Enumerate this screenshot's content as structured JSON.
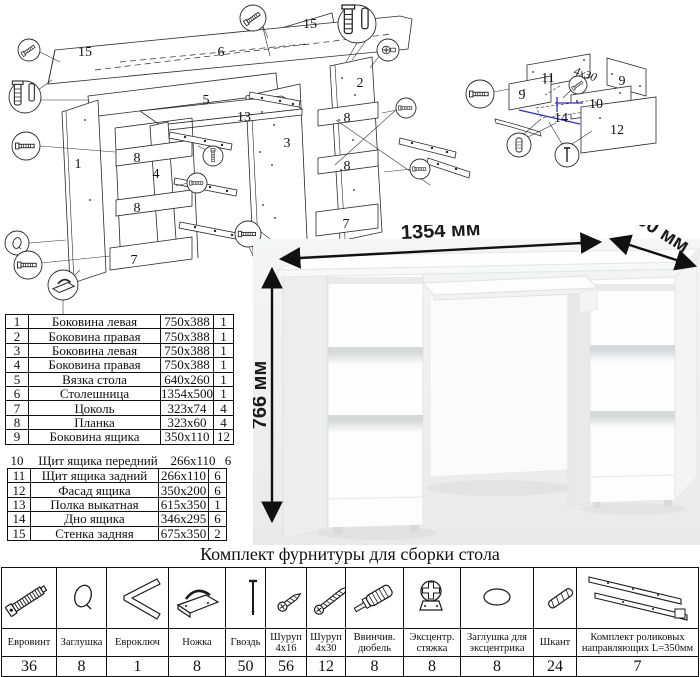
{
  "title": "Комплект фурнитуры для сборки стола",
  "parts_table": {
    "rows": [
      {
        "num": "1",
        "name": "Боковина левая",
        "size": "750x388",
        "qty": "1"
      },
      {
        "num": "2",
        "name": "Боковина правая",
        "size": "750x388",
        "qty": "1"
      },
      {
        "num": "3",
        "name": "Боковина левая",
        "size": "750x388",
        "qty": "1"
      },
      {
        "num": "4",
        "name": "Боковина правая",
        "size": "750x388",
        "qty": "1"
      },
      {
        "num": "5",
        "name": "Вязка стола",
        "size": "640x260",
        "qty": "1"
      },
      {
        "num": "6",
        "name": "Столешница",
        "size": "1354x500",
        "qty": "1"
      },
      {
        "num": "7",
        "name": "Цоколь",
        "size": "323x74",
        "qty": "4"
      },
      {
        "num": "8",
        "name": "Планка",
        "size": "323x60",
        "qty": "4"
      },
      {
        "num": "9",
        "name": "Боковина ящика",
        "size": "350x110",
        "qty": "12"
      },
      {
        "num": "10",
        "name": "Щит ящика передний",
        "size": "266x110",
        "qty": "6"
      },
      {
        "num": "11",
        "name": "Щит ящика задний",
        "size": "266x110",
        "qty": "6"
      },
      {
        "num": "12",
        "name": "Фасад ящика",
        "size": "350x200",
        "qty": "6"
      },
      {
        "num": "13",
        "name": "Полка выкатная",
        "size": "615x350",
        "qty": "1"
      },
      {
        "num": "14",
        "name": "Дно ящика",
        "size": "346x295",
        "qty": "6"
      },
      {
        "num": "15",
        "name": "Стенка задняя",
        "size": "675x350",
        "qty": "2"
      }
    ]
  },
  "dimensions": {
    "width": "1354 мм",
    "depth": "500 мм",
    "height": "766 мм"
  },
  "hardware": {
    "columns": [
      {
        "label": "Евровинт",
        "qty": "36",
        "icon": "euro-screw"
      },
      {
        "label": "Заглушка",
        "qty": "8",
        "icon": "cap"
      },
      {
        "label": "Евроключ",
        "qty": "1",
        "icon": "hex-key"
      },
      {
        "label": "Ножка",
        "qty": "8",
        "icon": "foot"
      },
      {
        "label": "Гвоздь",
        "qty": "50",
        "icon": "nail"
      },
      {
        "label": "Шуруп 4x16",
        "qty": "56",
        "icon": "screw-small"
      },
      {
        "label": "Шуруп 4x30",
        "qty": "12",
        "icon": "screw-long"
      },
      {
        "label": "Ввинчив. дюбель",
        "qty": "8",
        "icon": "dowel-screw"
      },
      {
        "label": "Эксцентр. стяжка",
        "qty": "8",
        "icon": "cam-lock"
      },
      {
        "label": "Заглушка для эксцентрика",
        "qty": "8",
        "icon": "cam-cap"
      },
      {
        "label": "Шкант",
        "qty": "24",
        "icon": "wood-dowel"
      },
      {
        "label": "Комплект роликовых направляющих L=350мм",
        "qty": "7",
        "icon": "drawer-slides"
      }
    ]
  },
  "diagrams": {
    "main_labels": [
      {
        "t": "15",
        "x": 85,
        "y": 56
      },
      {
        "t": "6",
        "x": 221,
        "y": 56
      },
      {
        "t": "15",
        "x": 310,
        "y": 28
      },
      {
        "t": "5",
        "x": 206,
        "y": 104
      },
      {
        "t": "13",
        "x": 244,
        "y": 121
      },
      {
        "t": "2",
        "x": 360,
        "y": 87
      },
      {
        "t": "1",
        "x": 78,
        "y": 168
      },
      {
        "t": "8",
        "x": 137,
        "y": 162
      },
      {
        "t": "4",
        "x": 156,
        "y": 178
      },
      {
        "t": "8",
        "x": 137,
        "y": 212
      },
      {
        "t": "7",
        "x": 134,
        "y": 264
      },
      {
        "t": "3",
        "x": 287,
        "y": 147
      },
      {
        "t": "8",
        "x": 347,
        "y": 122
      },
      {
        "t": "8",
        "x": 347,
        "y": 170
      },
      {
        "t": "7",
        "x": 346,
        "y": 228
      }
    ],
    "drawer_labels": [
      {
        "t": "11",
        "x": 548,
        "y": 82
      },
      {
        "t": "9",
        "x": 622,
        "y": 85
      },
      {
        "t": "9",
        "x": 522,
        "y": 99
      },
      {
        "t": "10",
        "x": 596,
        "y": 108
      },
      {
        "t": "14",
        "x": 561,
        "y": 122
      },
      {
        "t": "12",
        "x": 617,
        "y": 134
      }
    ],
    "annotation": "4x30"
  }
}
